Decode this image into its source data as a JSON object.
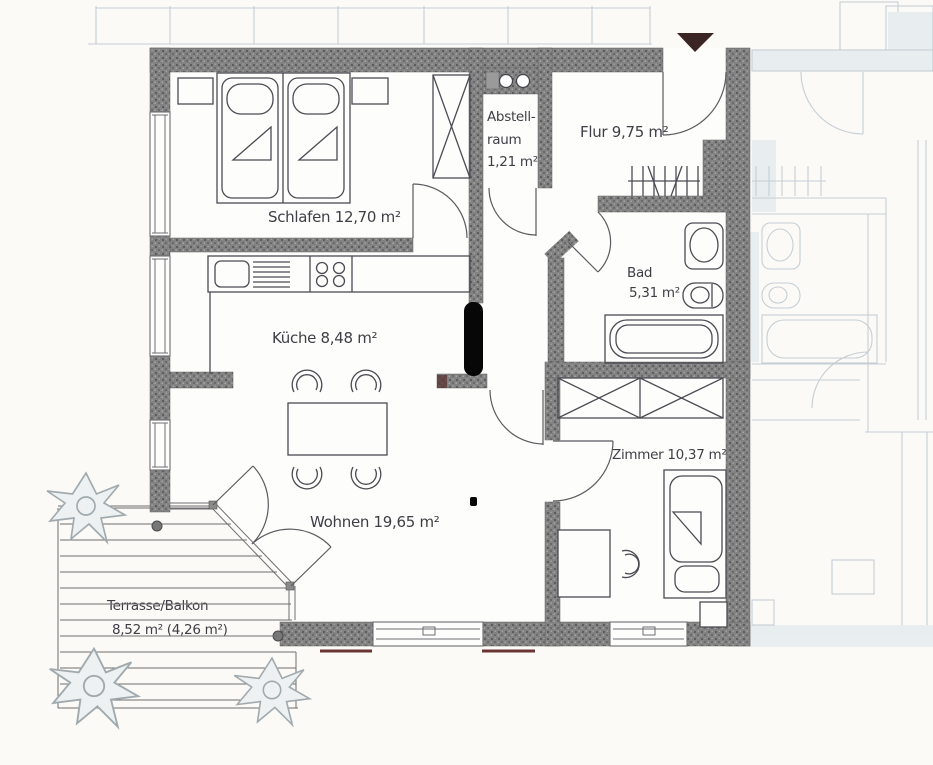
{
  "rooms": {
    "schlafen": {
      "label": "Schlafen 12,70 m²"
    },
    "abstellraum": {
      "line1": "Abstell-",
      "line2": "raum",
      "line3": "1,21 m²"
    },
    "flur": {
      "label": "Flur 9,75 m²"
    },
    "bad": {
      "name": "Bad",
      "area": "5,31 m²"
    },
    "kueche": {
      "label": "Küche 8,48 m²"
    },
    "wohnen": {
      "label": "Wohnen 19,65 m²"
    },
    "zimmer": {
      "label": "Zimmer 10,37 m²"
    },
    "terrasse": {
      "name": "Terrasse/Balkon",
      "area": "8,52 m² (4,26 m²)"
    }
  },
  "palette": {
    "paper": "#fbfaf7",
    "wall": "#828282",
    "wall_speck_dark": "#5d5d5d",
    "line": "#4b4b54",
    "label_text": "#3e3e46",
    "neighbor_line": "#c0cad2",
    "window_sill": "#6a3434",
    "entrance_arrow": "#3a2424",
    "redaction": "#070707"
  }
}
